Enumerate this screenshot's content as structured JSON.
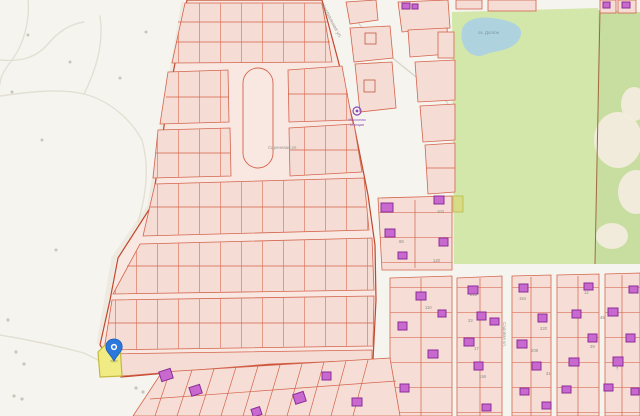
{
  "map": {
    "kind": "public-cadastral-map",
    "streets": {
      "diagonal": "Центральная ул.",
      "inner": "Сиреневая ул.",
      "vertical": "Садовая ул."
    },
    "pond_label": "оз. Долгое",
    "poi": {
      "name_line1": "Насосная",
      "name_line2": "станция"
    },
    "parcel_numbers": [
      "104",
      "88",
      "120",
      "218",
      "154",
      "12",
      "33",
      "220",
      "45",
      "17",
      "208",
      "29",
      "7",
      "156",
      "31",
      "110"
    ],
    "marker": {
      "kind": "location-pin",
      "color": "#2d78dd"
    },
    "selected_parcel": {
      "fill": "#f0eb82",
      "stroke": "#c4ba3e"
    },
    "colors": {
      "background": "#f6f4ef",
      "parcel_fill": "#f5dcd4",
      "parcel_road_fill": "#f9e8e2",
      "parcel_border": "#d4644c",
      "block_border": "#c0472c",
      "building_fill": "#c869cf",
      "building_border": "#8a2d96",
      "field_green": "#d3e7ab",
      "forest_green": "#c8dda0",
      "water": "#aed2de",
      "label_gray": "#9a978e"
    }
  }
}
